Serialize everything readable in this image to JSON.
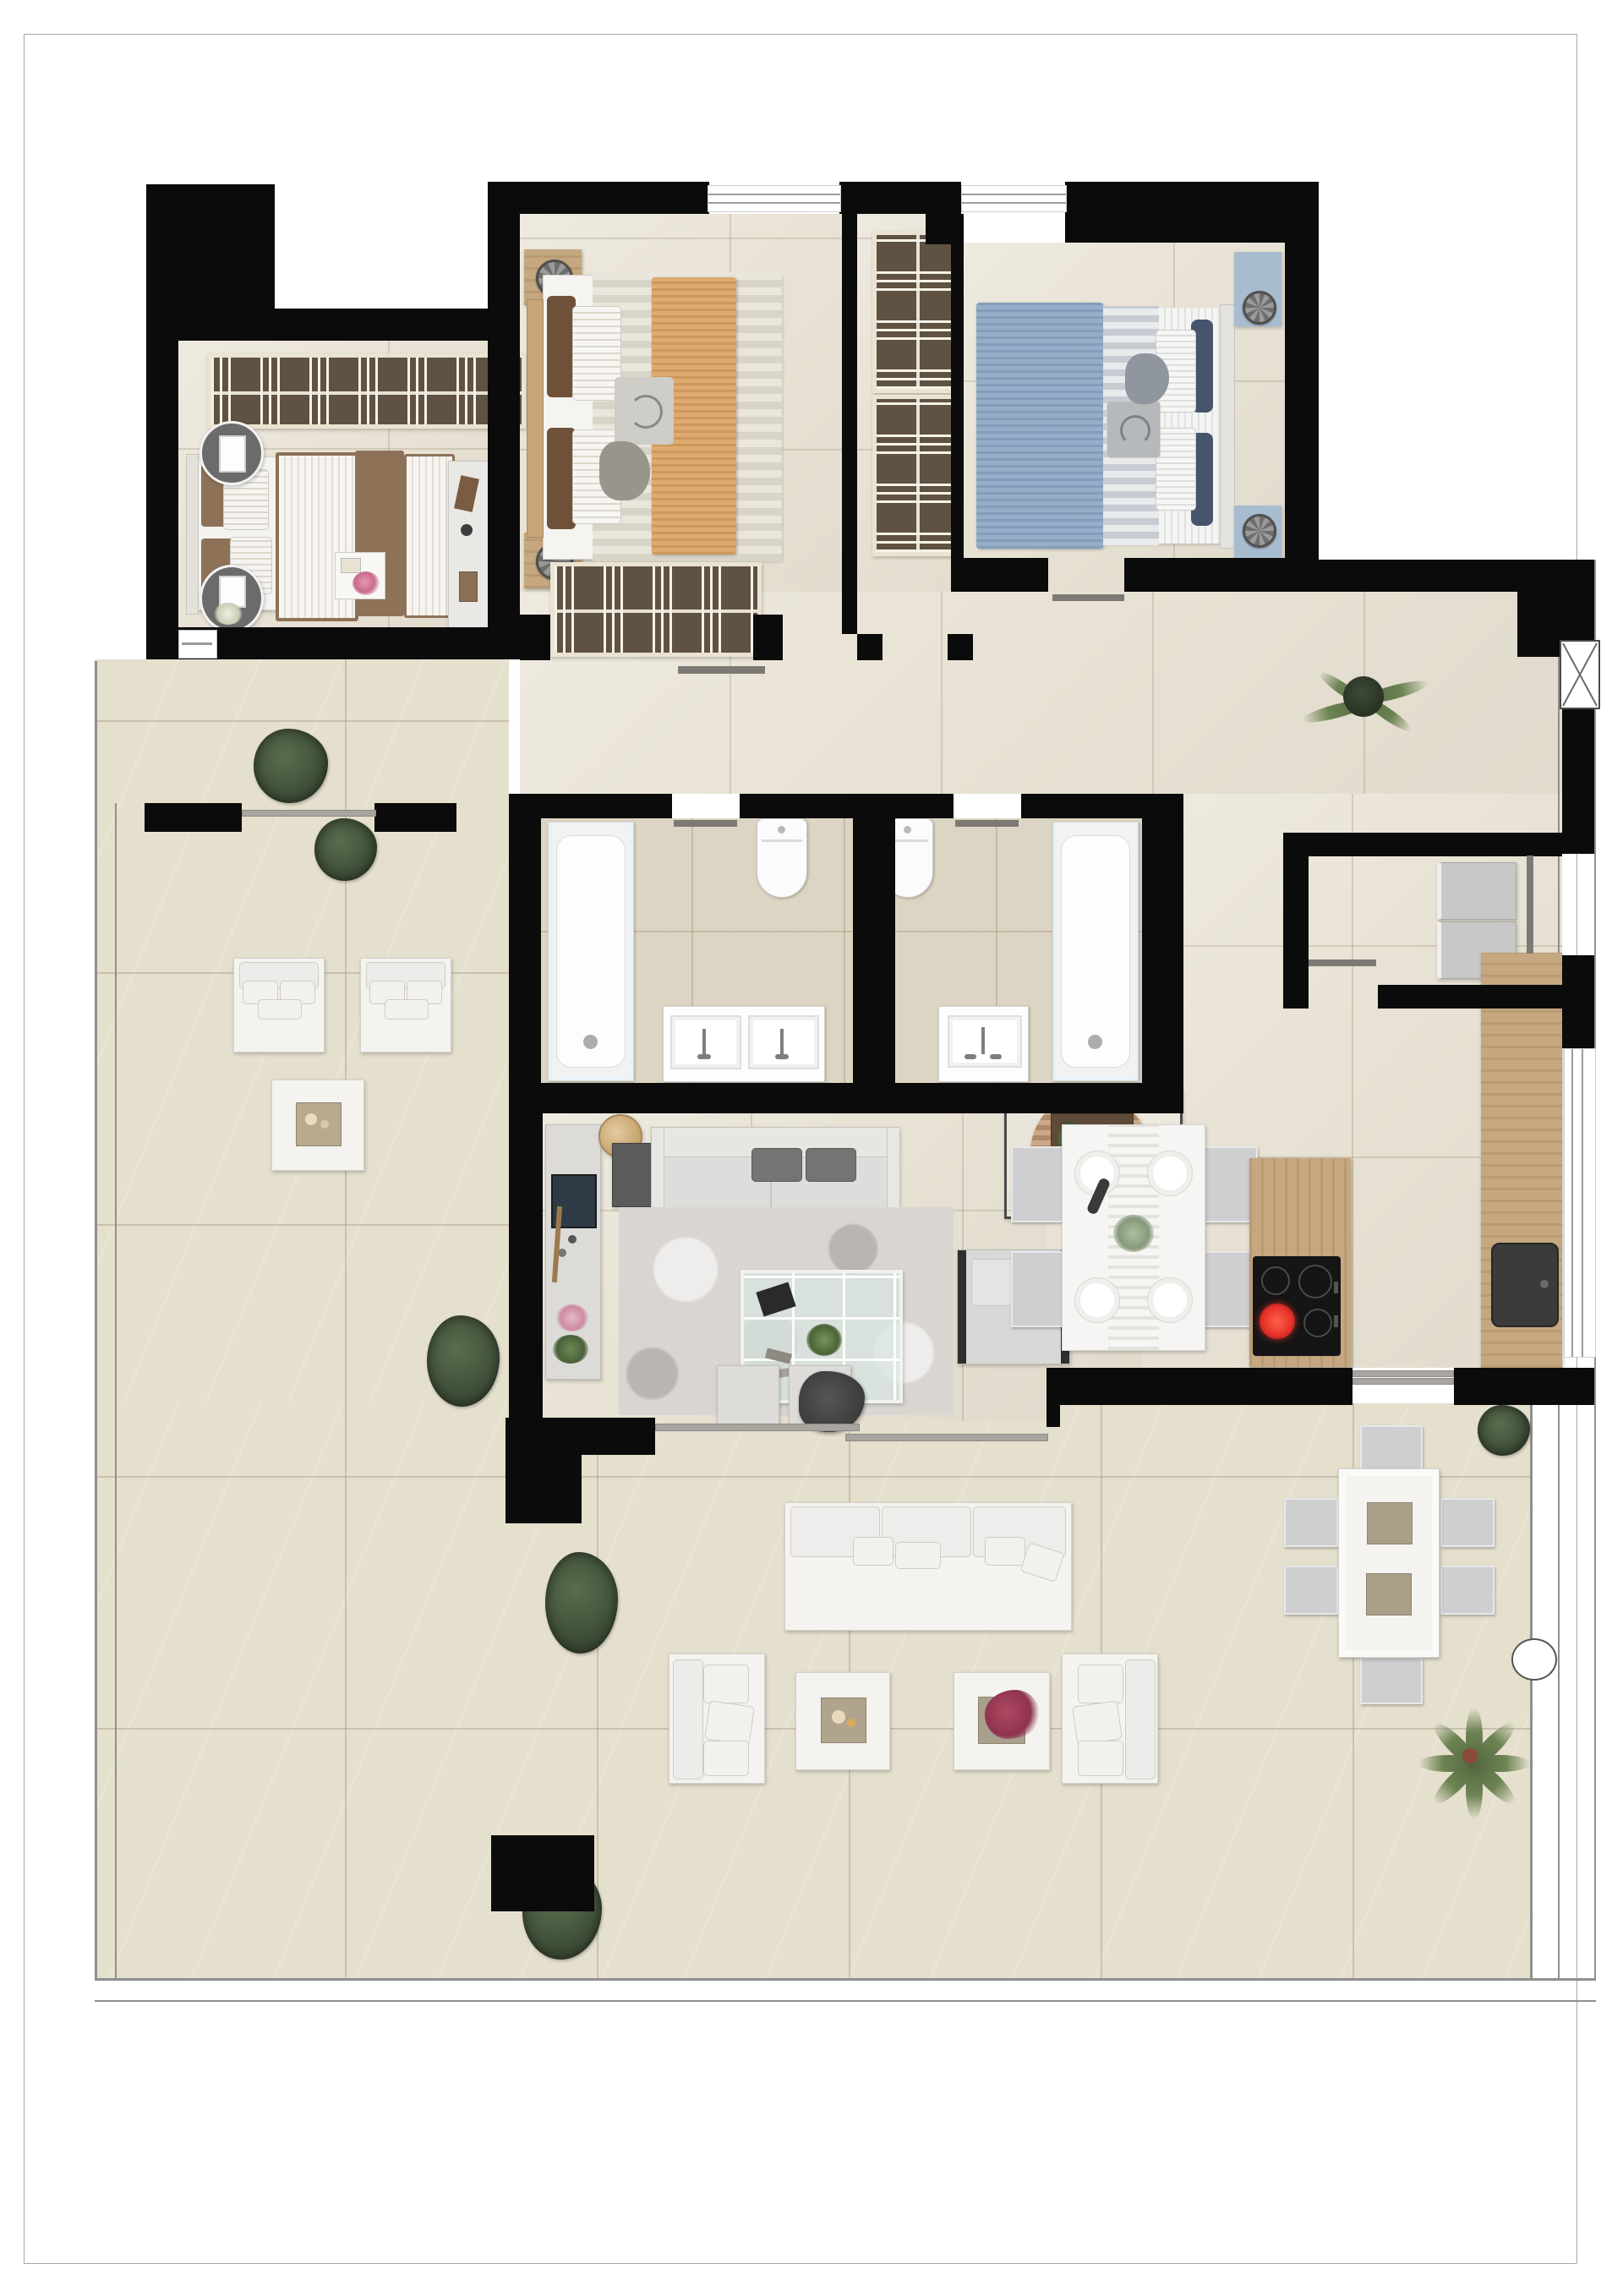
{
  "document": {
    "type": "architectural floor plan",
    "style": "top-down furnished 3D render, no text labels",
    "page_background": "#ffffff",
    "page_border_color": "#a8a8a8"
  },
  "palette": {
    "wall": "#0b0b0b",
    "floor_interior": "#e9e3d5",
    "floor_bath": "#ddd5c3",
    "floor_terrace": "#e5dfcd",
    "wood": "#c5a87f",
    "wood_dark": "#5f5243",
    "white_furniture": "#f4f3f0",
    "gray_sofa": "#dedddb",
    "dark_cushion": "#6f6f6e",
    "rug_gray": "#d9d6d2",
    "bed_brown": "#8d7258",
    "bed_orange": "#dfaa6e",
    "bed_blue": "#96aec8",
    "navy_pillow": "#46556b",
    "cooktop_black": "#151515",
    "burner_red": "#e8332a",
    "sink_dark": "#3b3b3b",
    "plant_green": "#42523a",
    "glass_table": "#d7e4dd",
    "railing_gray": "#8f8f8f"
  },
  "rooms": [
    {
      "name": "master-bedroom",
      "furniture": [
        "double-bed-brown-white",
        "oval-nightstand-with-lamp-x2",
        "full-width-wardrobe",
        "desk"
      ]
    },
    {
      "name": "bedroom-2",
      "furniture": [
        "double-bed-orange-throw",
        "wood-nightstand-x2",
        "wardrobe-bottom-wall"
      ]
    },
    {
      "name": "hall-closet",
      "furniture": [
        "wardrobe-x2"
      ]
    },
    {
      "name": "bedroom-3",
      "furniture": [
        "double-bed-blue-throw",
        "bedside-rug-x2"
      ]
    },
    {
      "name": "bathroom-1",
      "furniture": [
        "bathtub",
        "toilet",
        "double-vanity"
      ]
    },
    {
      "name": "bathroom-2",
      "furniture": [
        "toilet",
        "single-vanity",
        "bathtub"
      ]
    },
    {
      "name": "laundry-room",
      "furniture": [
        "washer",
        "dryer"
      ]
    },
    {
      "name": "entry-hall",
      "furniture": [
        "fern-plant"
      ]
    },
    {
      "name": "living-room",
      "furniture": [
        "sofa",
        "sideboard",
        "round-side-table",
        "glass-coffee-table",
        "gray-rug",
        "armchair",
        "tv-media-unit",
        "pouf-x2"
      ]
    },
    {
      "name": "dining-area",
      "furniture": [
        "table-for-4",
        "chairs-x4",
        "plates-x4",
        "centerpiece"
      ]
    },
    {
      "name": "kitchen",
      "furniture": [
        "island-with-cooktop",
        "tall-counter",
        "dark-sink"
      ]
    },
    {
      "name": "terrace",
      "furniture": [
        "lounge-chair-x2",
        "side-table",
        "outdoor-sofa",
        "outdoor-armchair-x2",
        "outdoor-side-table-x2",
        "outdoor-dining-table",
        "outdoor-chairs-x6",
        "bushes-x6",
        "palm-plant",
        "round-column"
      ]
    }
  ],
  "openings": [
    "window-top-x2",
    "window-right-glazed",
    "window-kitchen-right",
    "sliding-door-living",
    "sliding-door-kitchen",
    "sliding-door-terrace-partition",
    "entry-door-right",
    "interior-doors"
  ]
}
